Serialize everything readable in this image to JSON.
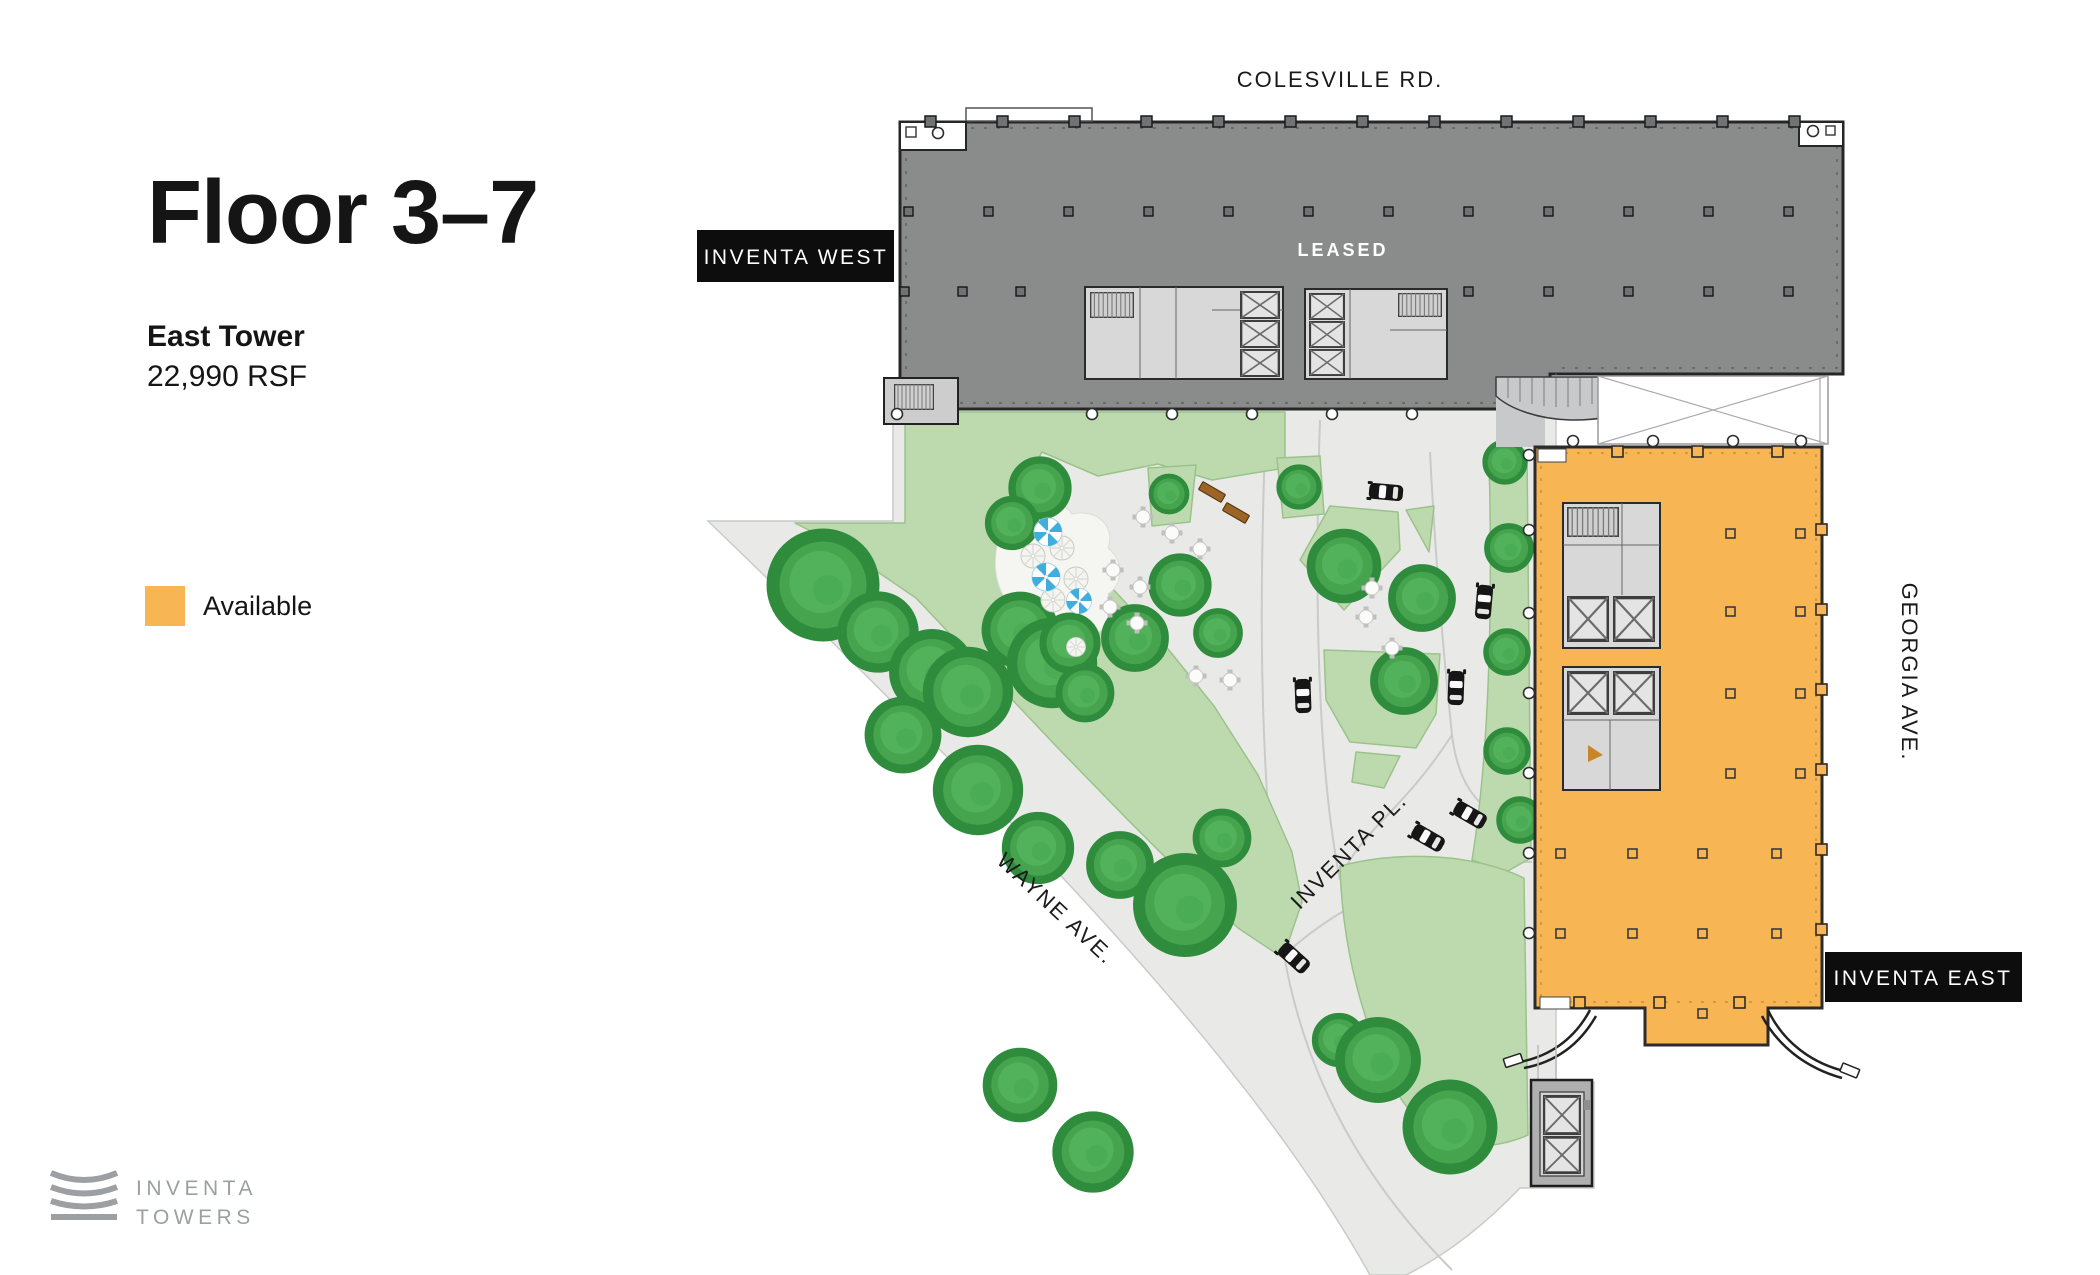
{
  "panel": {
    "title": "Floor 3–7",
    "tower_name": "East Tower",
    "area": "22,990 RSF",
    "legend": {
      "label": "Available",
      "color": "#F8B554"
    }
  },
  "logo": {
    "line1": "INVENTA",
    "line2": "TOWERS"
  },
  "map": {
    "roads": {
      "colesville": "COLESVILLE RD.",
      "georgia": "GEORGIA AVE.",
      "wayne": "WAYNE AVE.",
      "inventa_pl": "INVENTA PL."
    },
    "buildings": {
      "west": {
        "name": "INVENTA WEST",
        "status": "LEASED",
        "color": "#8A8C8C"
      },
      "east": {
        "name": "INVENTA EAST",
        "status": "Available",
        "color": "#F8B554"
      }
    }
  },
  "colors": {
    "available": "#F8B554",
    "leased": "#8A8C8C",
    "lawn": "#BCDAAD",
    "tree": "#46A44F",
    "plaza": "#E9EAE8",
    "label_bg": "#0D0D0D"
  }
}
